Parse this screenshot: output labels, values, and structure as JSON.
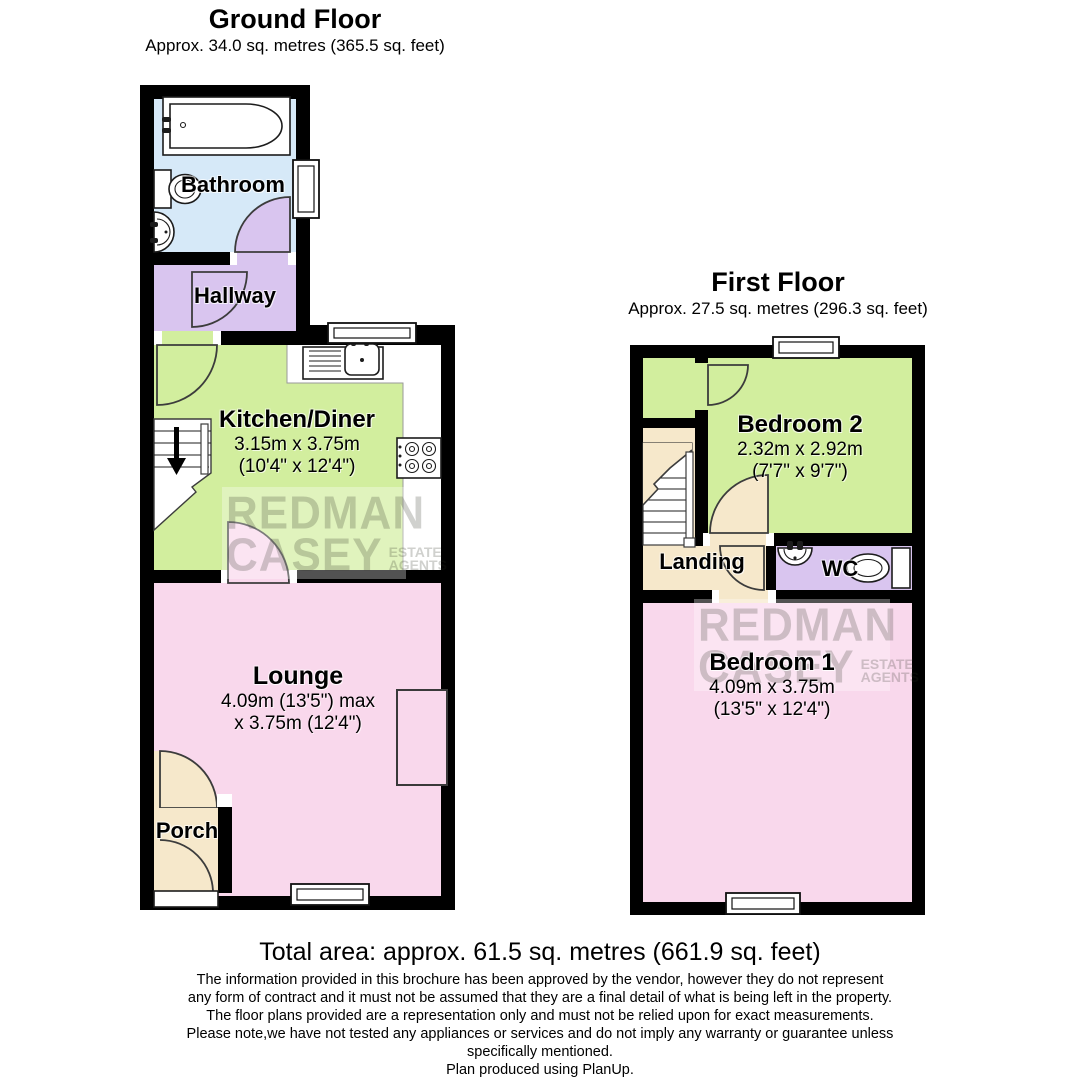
{
  "ground_floor": {
    "title": "Ground Floor",
    "area": "Approx. 34.0 sq. metres (365.5 sq. feet)",
    "rooms": {
      "bathroom": {
        "label": "Bathroom"
      },
      "hallway": {
        "label": "Hallway"
      },
      "kitchen": {
        "label": "Kitchen/Diner",
        "dims_metric": "3.15m x 3.75m",
        "dims_imperial": "(10'4\" x 12'4\")"
      },
      "lounge": {
        "label": "Lounge",
        "dims_line1": "4.09m (13'5\") max",
        "dims_line2": "x 3.75m (12'4\")"
      },
      "porch": {
        "label": "Porch"
      }
    }
  },
  "first_floor": {
    "title": "First Floor",
    "area": "Approx. 27.5 sq. metres (296.3 sq. feet)",
    "rooms": {
      "bedroom2": {
        "label": "Bedroom 2",
        "dims_metric": "2.32m x 2.92m",
        "dims_imperial": "(7'7\" x 9'7\")"
      },
      "landing": {
        "label": "Landing"
      },
      "wc": {
        "label": "WC"
      },
      "bedroom1": {
        "label": "Bedroom 1",
        "dims_metric": "4.09m x 3.75m",
        "dims_imperial": "(13'5\" x 12'4\")"
      }
    }
  },
  "watermark": {
    "line1": "REDMAN",
    "line2": "CASEY",
    "sub1": "ESTATE",
    "sub2": "AGENTS"
  },
  "footer": {
    "total": "Total area: approx. 61.5 sq. metres (661.9 sq. feet)",
    "disclaimer_lines": [
      "The information provided in this brochure has been approved by the vendor, however they do not represent",
      "any form of contract and it must not be assumed that they are a final detail of what is being left in the property.",
      "The floor plans provided are a representation only and must not be relied upon for exact measurements.",
      "Please note,we have not tested any appliances or services and do not imply any warranty or guarantee unless",
      "specifically mentioned.",
      "Plan produced using PlanUp."
    ]
  },
  "colors": {
    "wall": "#000000",
    "blue": "#d6e9f8",
    "purple": "#d9c5ef",
    "green": "#d2ee9e",
    "pink": "#f9d8ec",
    "cream": "#f6e8cb"
  }
}
